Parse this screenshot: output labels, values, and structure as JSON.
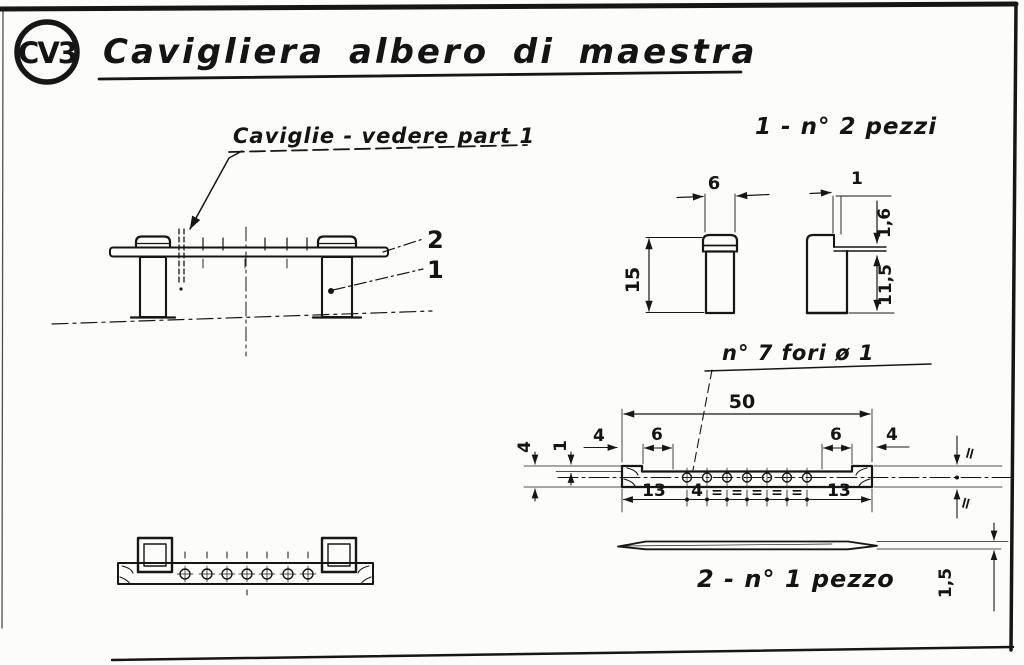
{
  "sheet": {
    "code": "CV3",
    "title": "Cavigliera albero di maestra"
  },
  "notes": {
    "caviglie": "Caviglie - vedere part 1",
    "part1_qty": "1 - n° 2 pezzi",
    "holes": "n° 7 fori ø 1",
    "part2_qty": "2 - n° 1 pezzo"
  },
  "callouts": {
    "rail_item": "2",
    "post_item": "1"
  },
  "dims": {
    "part1": {
      "width": "6",
      "height": "15",
      "slot_width": "1",
      "slot_depth": "1,6",
      "below_slot": "11,5"
    },
    "part2": {
      "length": "50",
      "end_left": "4",
      "seat_left": "6",
      "seat_right": "6",
      "end_right": "4",
      "width": "4",
      "edge": "1",
      "thickness": "1,5",
      "equal": "=",
      "chain": [
        "13",
        "4",
        "=",
        "=",
        "=",
        "=",
        "=",
        "13"
      ]
    }
  }
}
